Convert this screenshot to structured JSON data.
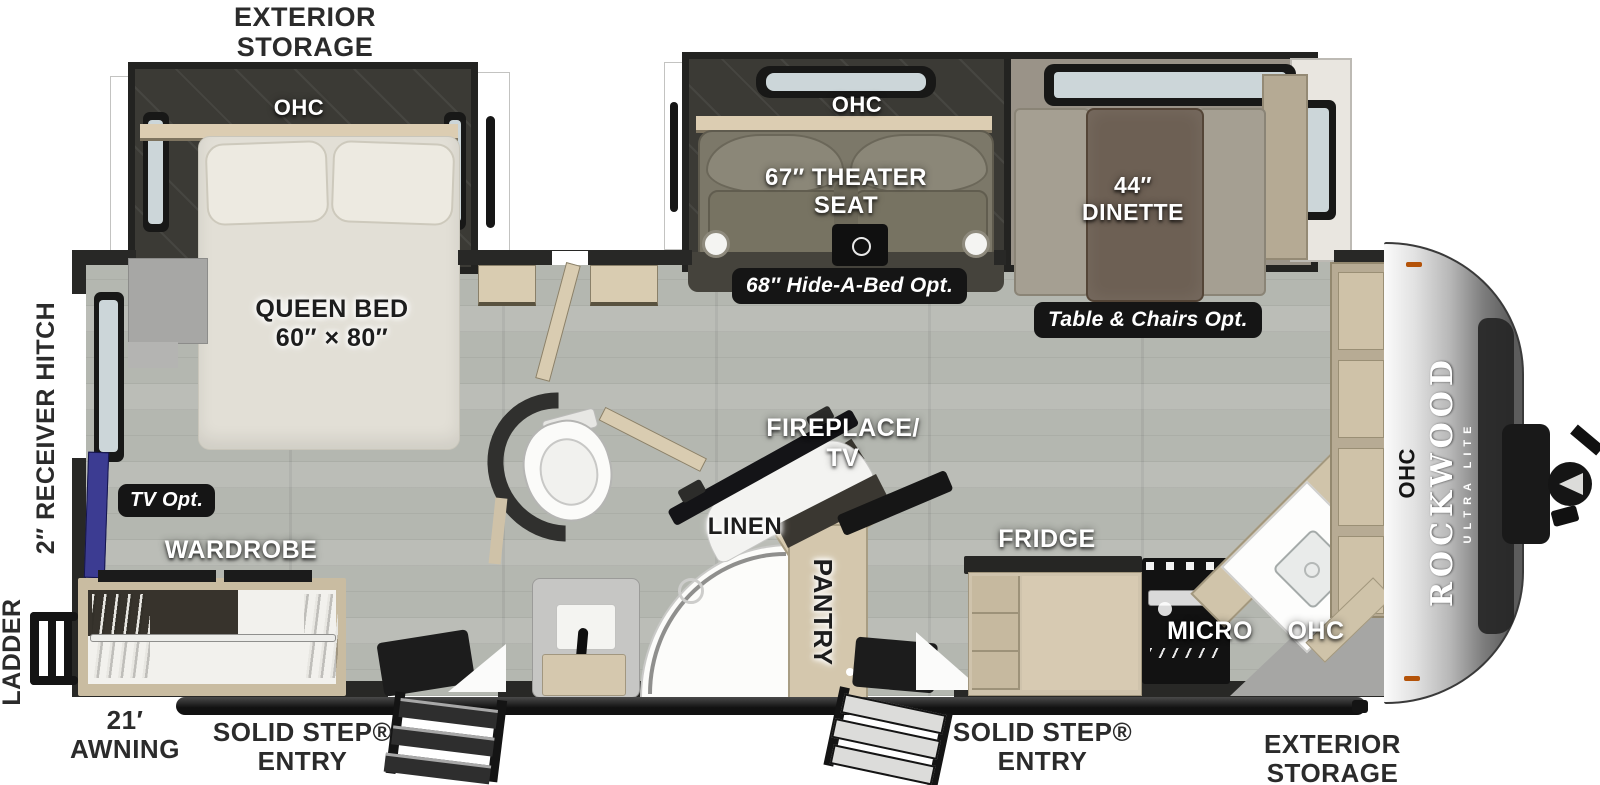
{
  "type": "rv-floorplan",
  "brand": {
    "name": "ROCKWOOD",
    "series": "ULTRA LITE"
  },
  "exterior_labels": {
    "storage_rear_line1": "EXTERIOR",
    "storage_rear_line2": "STORAGE",
    "receiver_hitch": "2″ RECEIVER HITCH",
    "ladder": "LADDER",
    "awning_line1": "21′",
    "awning_line2": "AWNING",
    "entry_left_line1": "SOLID STEP®",
    "entry_left_line2": "ENTRY",
    "entry_right_line1": "SOLID STEP®",
    "entry_right_line2": "ENTRY",
    "storage_front_line1": "EXTERIOR",
    "storage_front_line2": "STORAGE"
  },
  "interior_labels": {
    "bedroom_ohc": "OHC",
    "queen_bed_line1": "QUEEN BED",
    "queen_bed_line2": "60″ × 80″",
    "tv_opt": "TV Opt.",
    "wardrobe": "WARDROBE",
    "theater_ohc": "OHC",
    "theater_line1": "67″ THEATER",
    "theater_line2": "SEAT",
    "hide_a_bed_opt": "68″ Hide-A-Bed Opt.",
    "dinette_line1": "44″",
    "dinette_line2": "DINETTE",
    "table_chairs_opt": "Table & Chairs Opt.",
    "fireplace_line1": "FIREPLACE/",
    "fireplace_line2": "TV",
    "linen": "LINEN",
    "pantry": "PANTRY",
    "fridge": "FRIDGE",
    "micro": "MICRO",
    "kitchen_ohc": "OHC",
    "front_ohc": "OHC"
  },
  "colors": {
    "floor_wood": "#b4b7b0",
    "wall": "#282826",
    "cabinet_tan": "#d3c6ac",
    "slide_floor_dark": "#3b3a35",
    "badge_bg": "#151515",
    "tv_blue": "#3c3c92",
    "marker_orange": "#b45309",
    "front_cap_silver": "#b7b7b7"
  }
}
